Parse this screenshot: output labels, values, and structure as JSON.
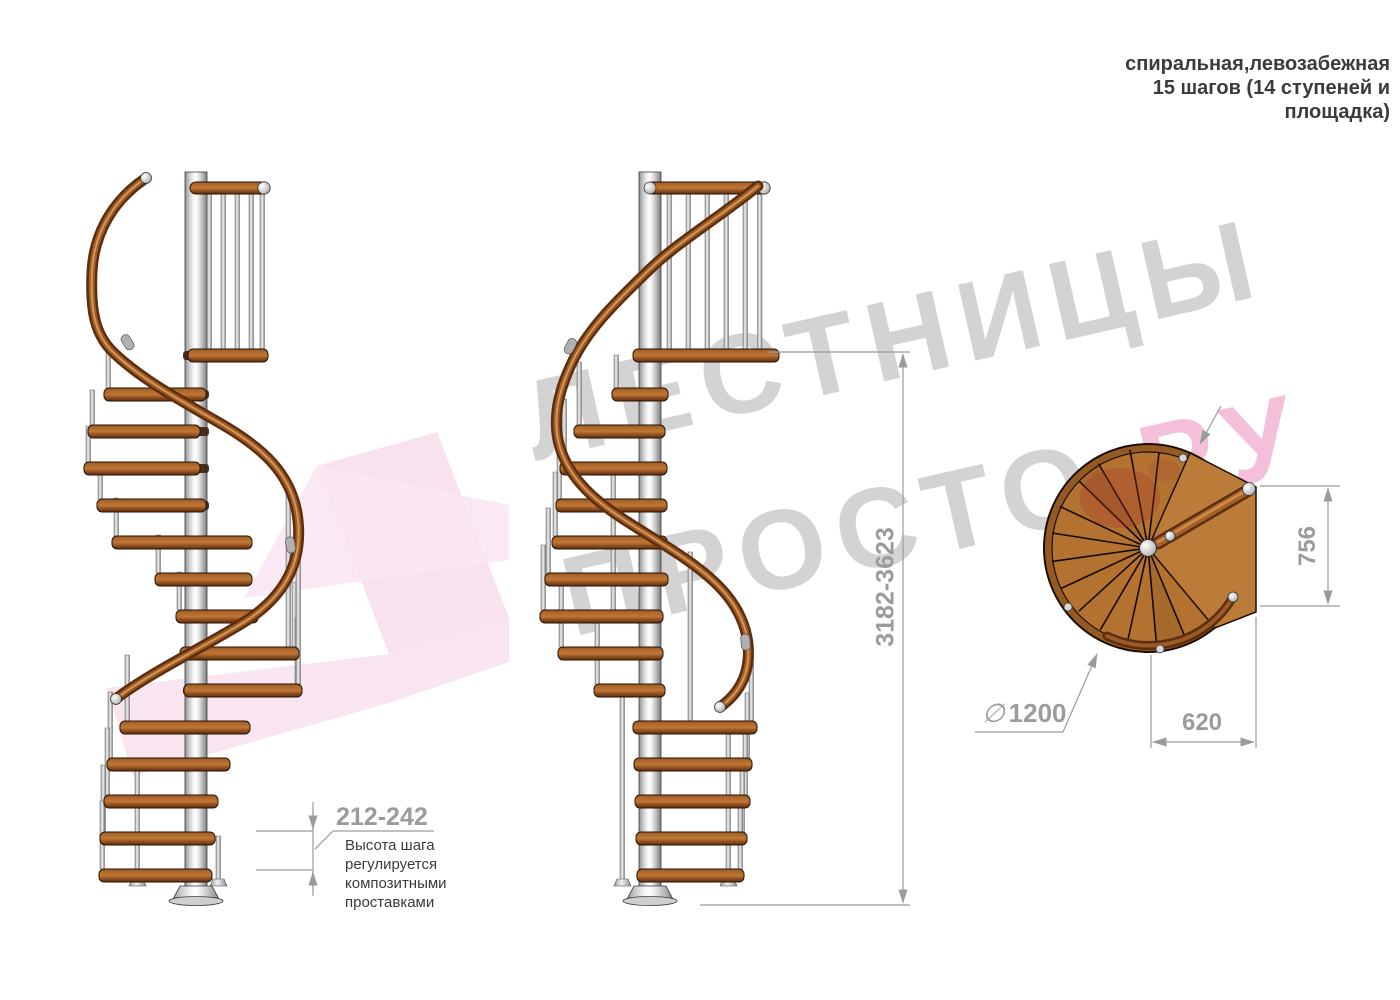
{
  "title": {
    "line1": "спиральная,левозабежная",
    "line2": "15 шагов (14 ступеней и",
    "line3": "площадка)"
  },
  "watermark": {
    "line1": "ЛЕСТНИЦЫ",
    "line2_gray": "ПРОСТО",
    "line2_pink": ".РУ"
  },
  "dimensions": {
    "total_height": "3182-3623",
    "platform_depth": "756",
    "platform_width": "620",
    "diameter_symbol": "∅",
    "diameter_value": "1200",
    "step_height": "212-242",
    "step_note": {
      "line1": "Высота шага",
      "line2": "регулируется",
      "line3": "композитными",
      "line4": "проставками"
    }
  },
  "colors": {
    "wood": "#b3722f",
    "handrail": "#7a4018",
    "metal": "#d9d9d9",
    "dimension_gray": "#9b9b9b",
    "watermark_gray": "#d3d3d3",
    "watermark_pink": "#f3bfd9",
    "title_text": "#3b3b3b"
  }
}
